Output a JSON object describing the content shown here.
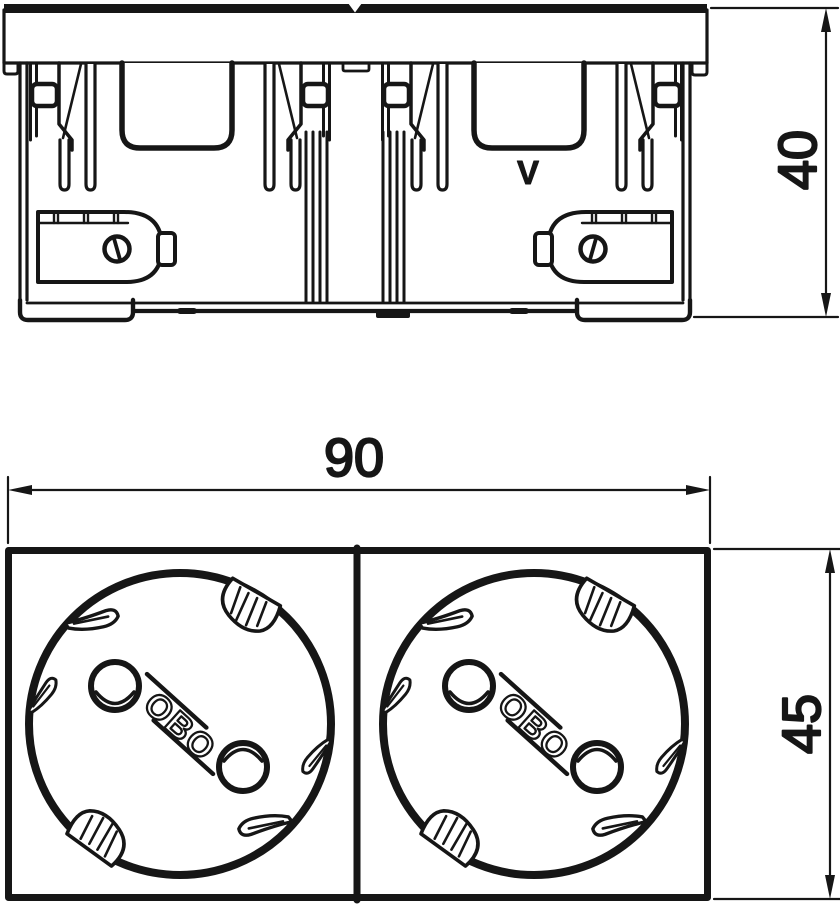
{
  "meta": {
    "background_color": "#ffffff",
    "ink_color": "#161616",
    "description": "Technical dimension drawing of a double socket outlet: side elevation (top) and front view (bottom)"
  },
  "views": {
    "side": {
      "dim_height": "40",
      "marking": "V"
    },
    "front": {
      "dim_width": "90",
      "dim_height": "45",
      "sockets": [
        {
          "logo": "OBO"
        },
        {
          "logo": "OBO"
        }
      ]
    }
  }
}
